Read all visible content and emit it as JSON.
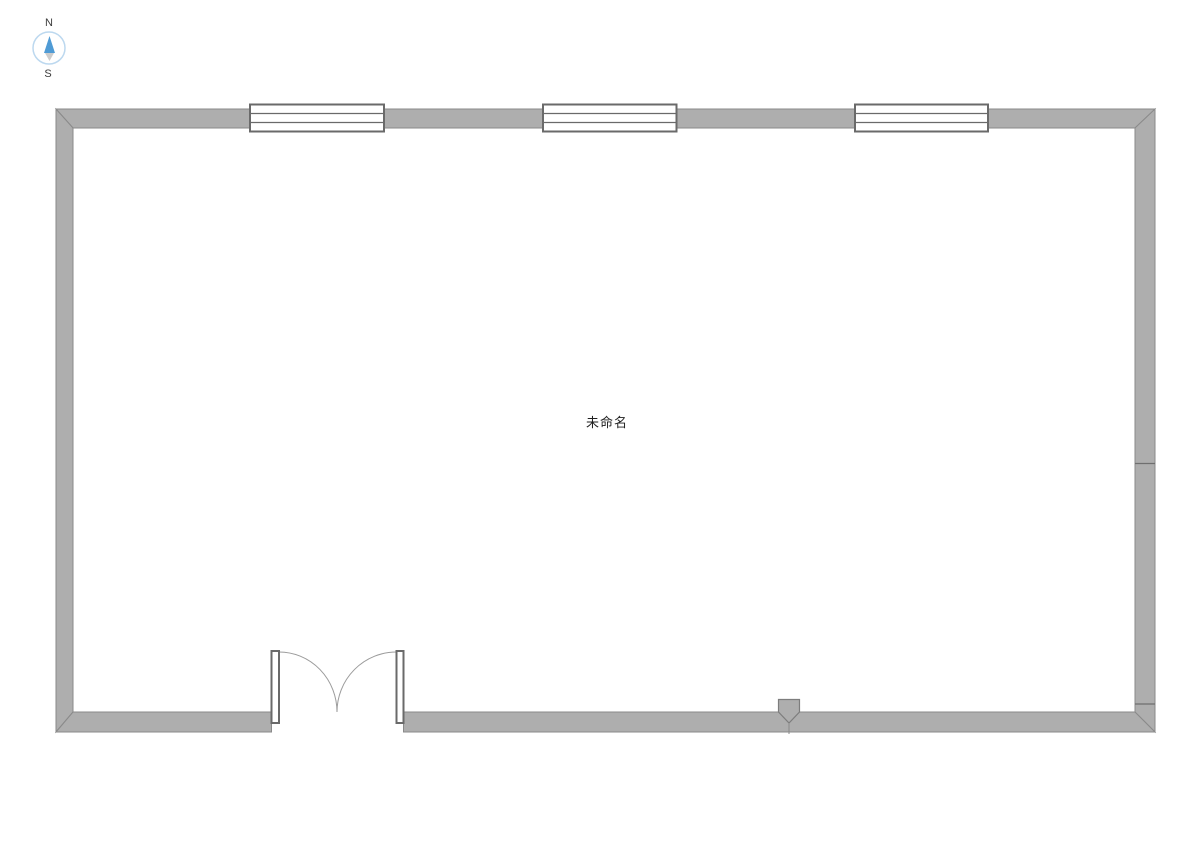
{
  "room": {
    "label": "未命名"
  },
  "compass": {
    "north_label": "N",
    "south_label": "S"
  },
  "floorplan": {
    "windows_count": 3,
    "door_type": "double-swing-door",
    "entry_marker": "wall-entry-marker",
    "right_wall_joint_count": 2
  },
  "colors": {
    "wall_fill": "#aeaeae",
    "wall_stroke": "#8a8a8a",
    "joint_line": "#6f6f6f",
    "window_stroke": "#6a6a6a",
    "door_leaf_stroke": "#6a6a6a",
    "door_arc_stroke": "#9b9b9b",
    "marker_fill": "#aeaeae",
    "compass_ring": "#bcd8ef",
    "compass_needle_north": "#4f9bd5",
    "compass_needle_south": "#cccccc",
    "room_label_color": "#1f1f1f",
    "background": "#ffffff"
  }
}
